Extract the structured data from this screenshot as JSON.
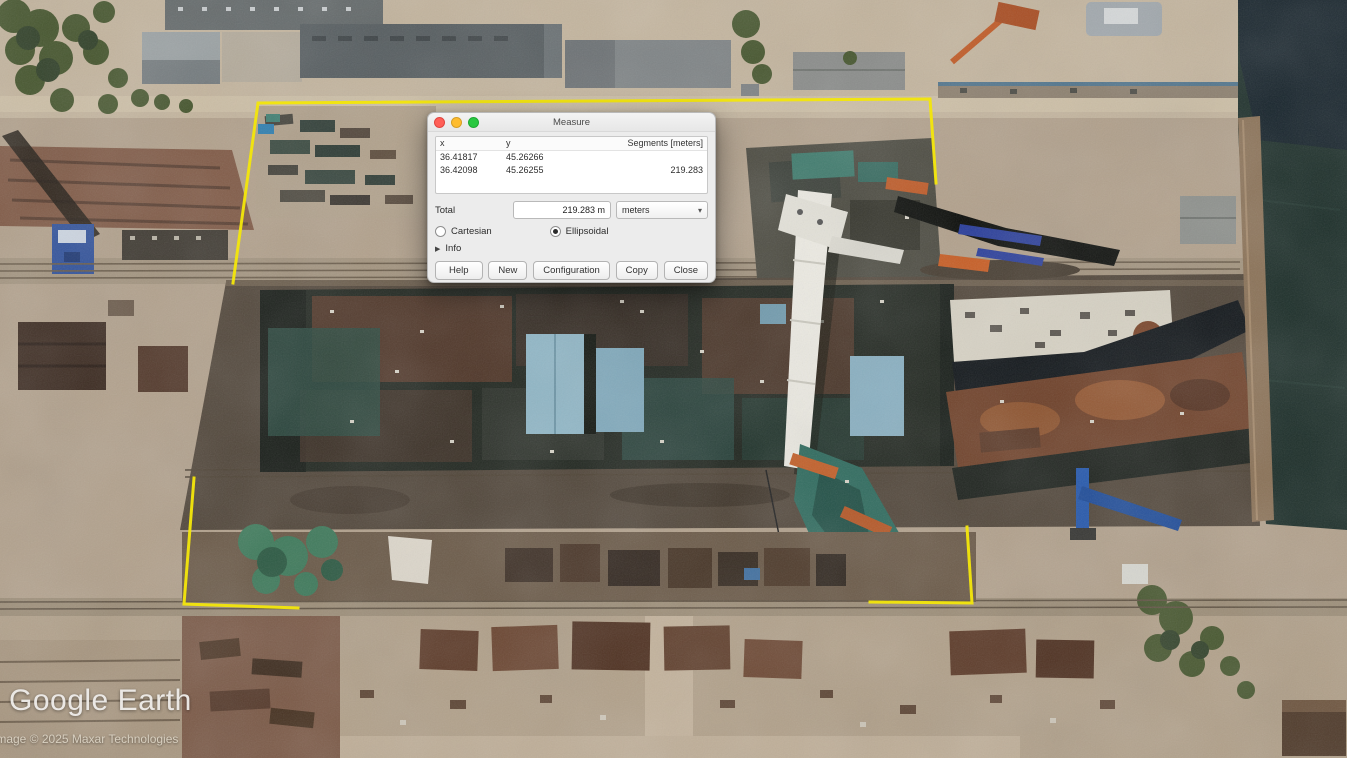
{
  "app": {
    "branding": "Google Earth",
    "attribution": "Image © 2025 Maxar Technologies"
  },
  "icons": {
    "caret_down": "▾",
    "triangle_right": "▶"
  },
  "colors": {
    "measurement_yellow": "#f2e50b"
  },
  "measure_dialog": {
    "title": "Measure",
    "columns": {
      "x": "x",
      "y": "y",
      "segments": "Segments [meters]"
    },
    "rows": [
      {
        "x": "36.41817",
        "y": "45.26266",
        "segment": ""
      },
      {
        "x": "36.42098",
        "y": "45.26255",
        "segment": "219.283"
      }
    ],
    "total_label": "Total",
    "total_value": "219.283 m",
    "unit_selected": "meters",
    "radio_cartesian": "Cartesian",
    "radio_ellipsoidal": "Ellipsoidal",
    "info_label": "Info",
    "buttons": {
      "help": "Help",
      "new": "New",
      "configuration": "Configuration",
      "copy": "Copy",
      "close": "Close"
    }
  }
}
